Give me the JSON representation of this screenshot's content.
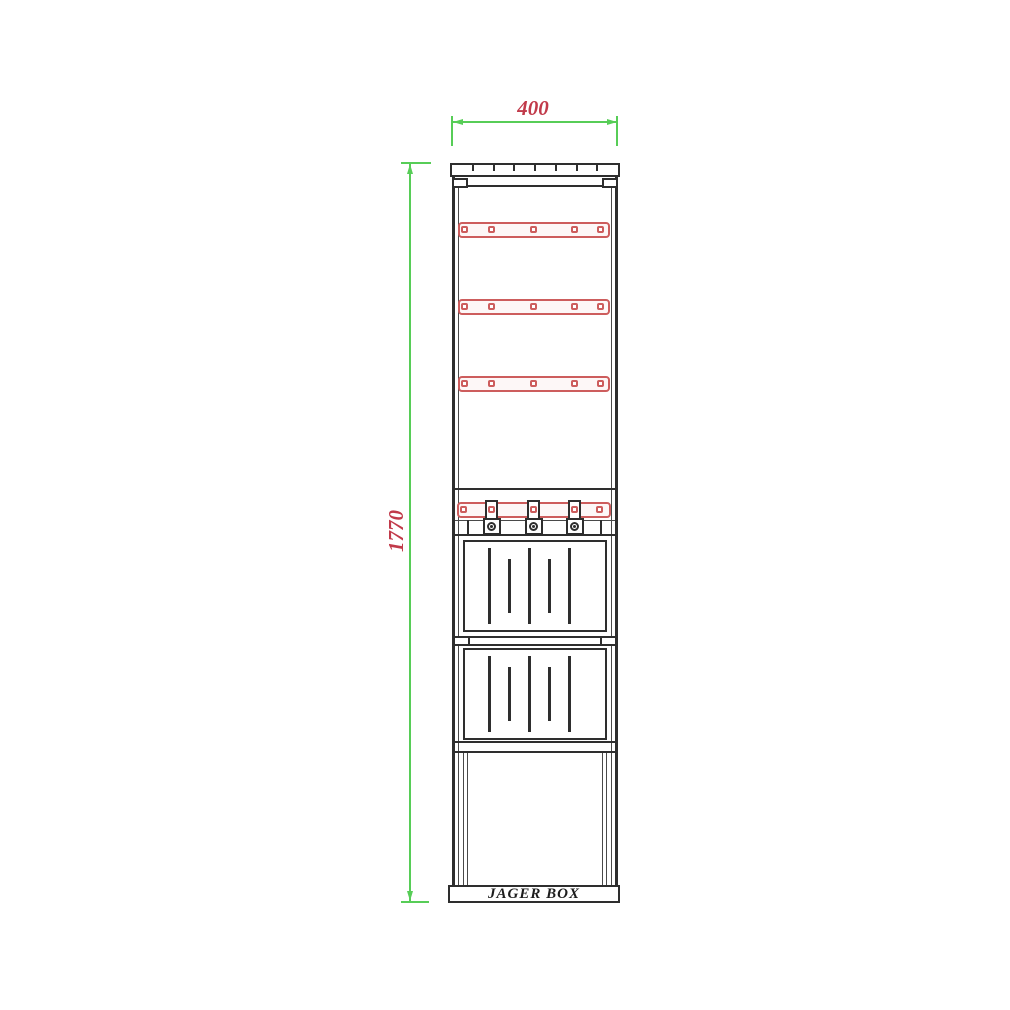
{
  "drawing": {
    "brand_label": "JAGER BOX",
    "dimensions": {
      "width_label": "400",
      "height_label": "1770"
    },
    "colors": {
      "dimension_line": "#57cd57",
      "dimension_text": "#c13a4a",
      "rail": "#cd5d5d",
      "outline": "#2e2e2e"
    },
    "components": {
      "top_tabs": 7,
      "mounting_rails": 4,
      "holes_per_rail": 5,
      "cable_clamps": 3,
      "vent_panels": 2,
      "slats_per_panel": 5
    }
  }
}
